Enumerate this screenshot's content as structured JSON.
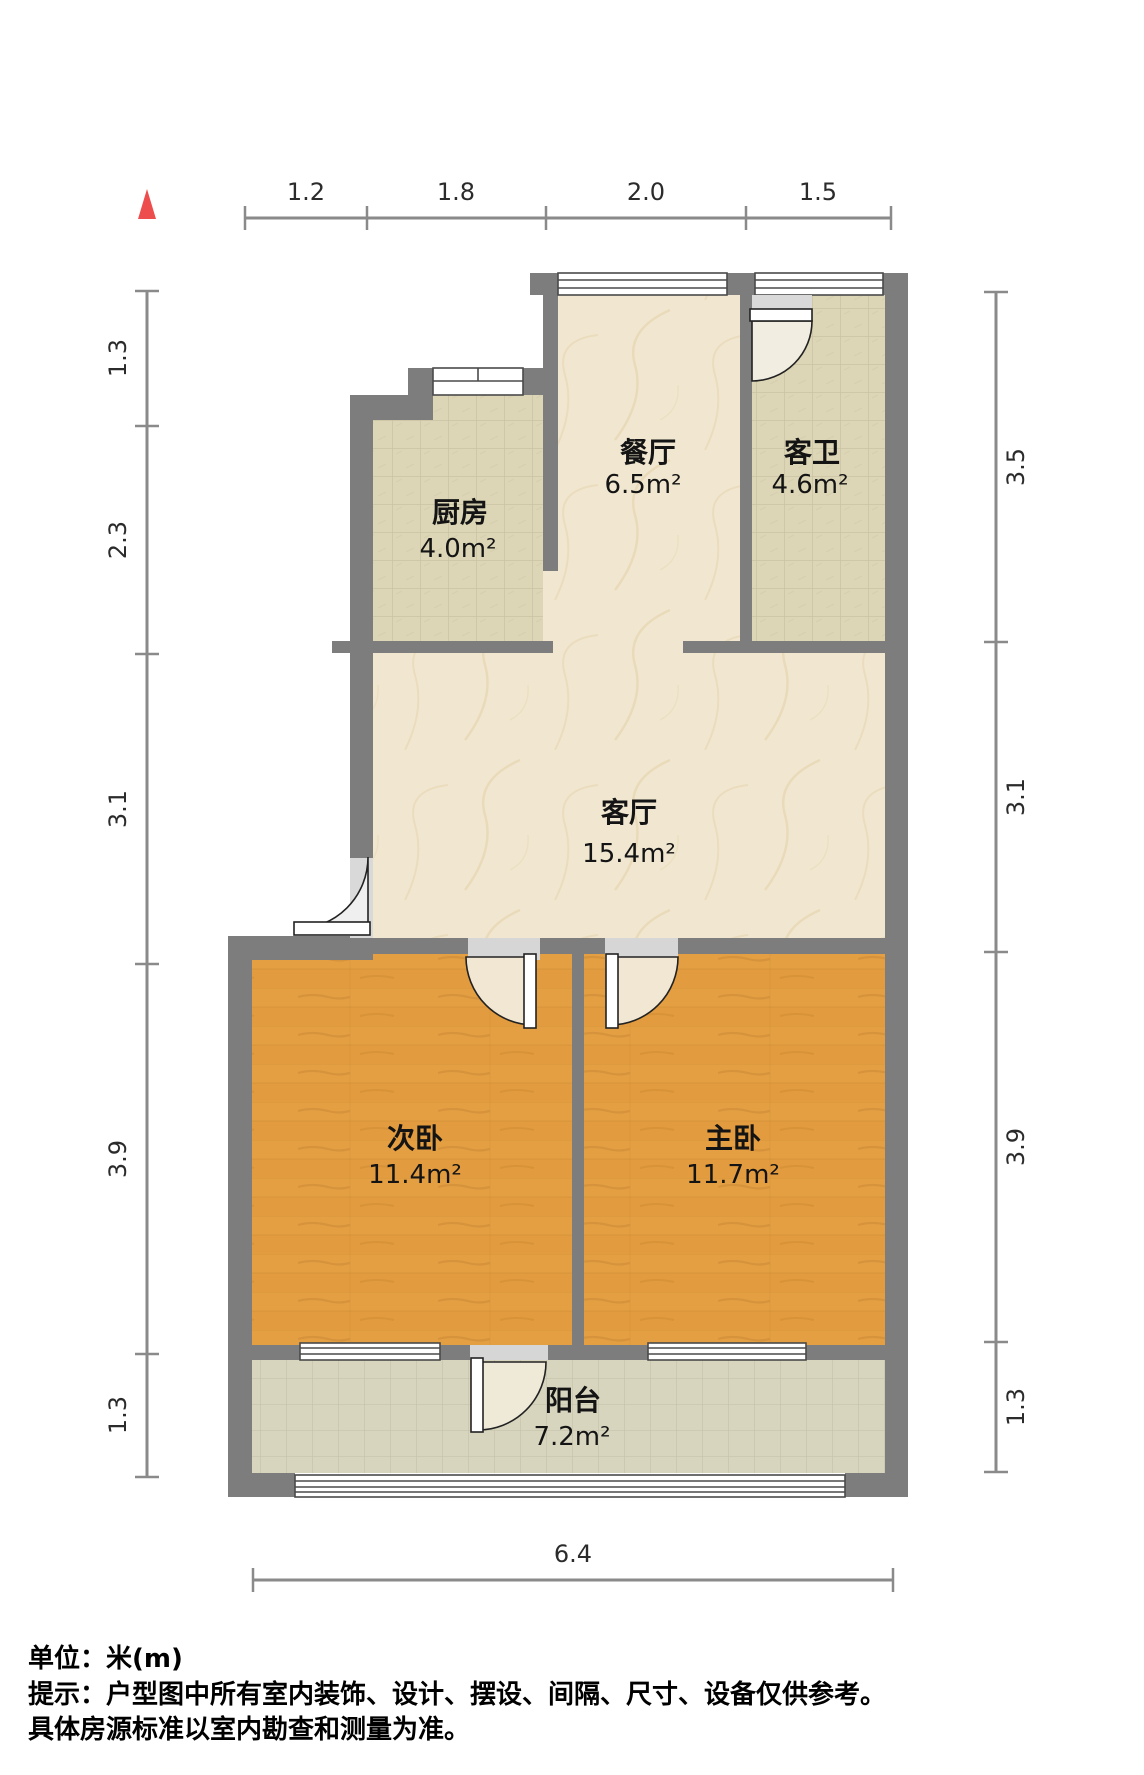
{
  "plan": {
    "rooms": [
      {
        "id": "dining",
        "name": "餐厅",
        "area": "6.5m²"
      },
      {
        "id": "bathroom",
        "name": "客卫",
        "area": "4.6m²"
      },
      {
        "id": "kitchen",
        "name": "厨房",
        "area": "4.0m²"
      },
      {
        "id": "living",
        "name": "客厅",
        "area": "15.4m²"
      },
      {
        "id": "bedroom2",
        "name": "次卧",
        "area": "11.4m²"
      },
      {
        "id": "master",
        "name": "主卧",
        "area": "11.7m²"
      },
      {
        "id": "balcony",
        "name": "阳台",
        "area": "7.2m²"
      }
    ],
    "dimensions": {
      "top": [
        "1.2",
        "1.8",
        "2.0",
        "1.5"
      ],
      "left": [
        "1.3",
        "2.3",
        "3.1",
        "3.9",
        "1.3"
      ],
      "right": [
        "3.5",
        "3.1",
        "3.9",
        "1.3"
      ],
      "bottom": [
        "6.4"
      ]
    },
    "colors": {
      "wall": "#7d7d7d",
      "wood_floor": "#e29b3e",
      "tile_floor": "#dcd6b6",
      "balcony_tile": "#d8d5bf",
      "marble_floor": "#f1e7d1",
      "north_marker": "#ee4d4d",
      "dim_line": "#8a8a8a"
    }
  },
  "footer": {
    "unit_line": "单位：米(m)",
    "tip_line1": "提示：户型图中所有室内装饰、设计、摆设、间隔、尺寸、设备仅供参考。",
    "tip_line2": "具体房源标准以室内勘查和测量为准。"
  }
}
